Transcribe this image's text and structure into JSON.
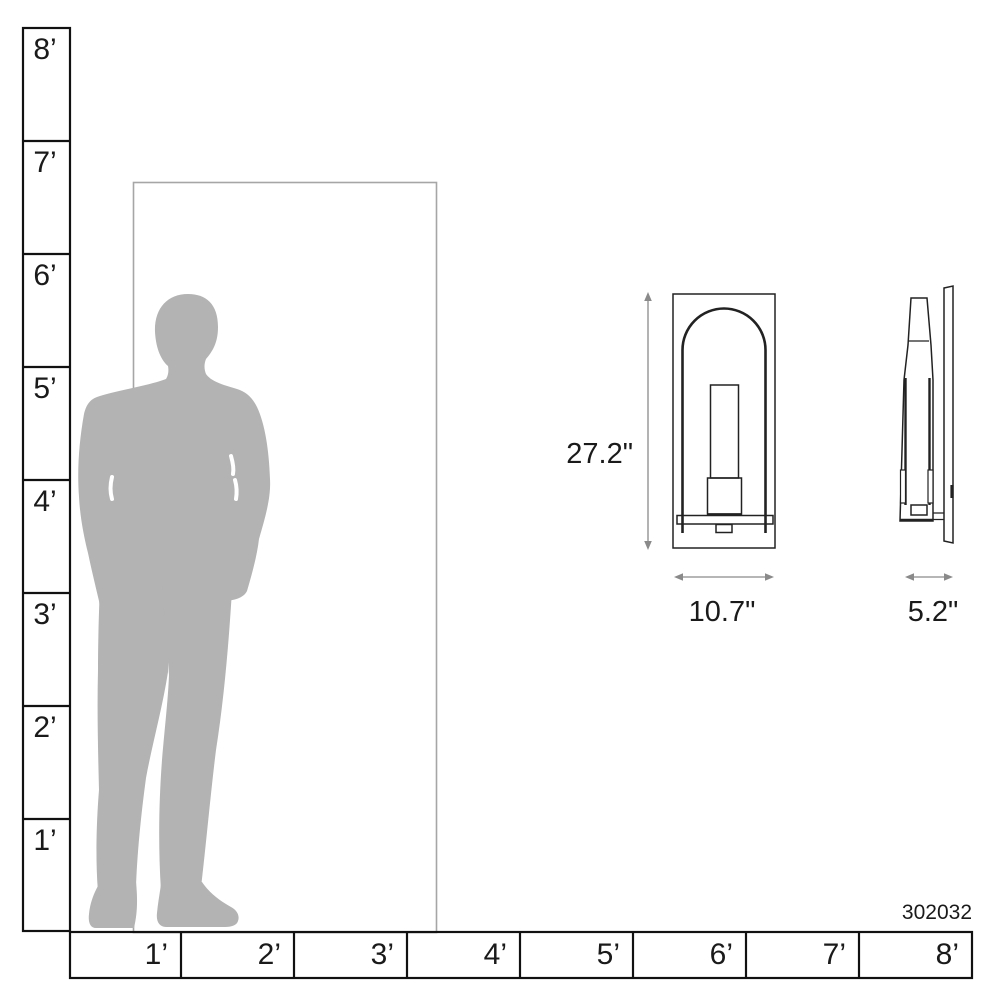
{
  "product": {
    "model_number": "302032"
  },
  "rulers": {
    "vertical": {
      "unit": "feet",
      "labels": [
        "8’",
        "7’",
        "6’",
        "5’",
        "4’",
        "3’",
        "2’",
        "1’"
      ]
    },
    "horizontal": {
      "unit": "feet",
      "labels": [
        "1’",
        "2’",
        "3’",
        "4’",
        "5’",
        "6’",
        "7’",
        "8’"
      ]
    }
  },
  "dimensions": {
    "height": "27.2\"",
    "width": "10.7\"",
    "depth": "5.2\""
  },
  "figures": {
    "person": "human-silhouette-scale-reference",
    "door": "door-outline-scale-reference",
    "front_view": "sconce-front-view",
    "side_view": "sconce-side-view"
  },
  "colors": {
    "silhouette": "#b3b3b3",
    "door_line": "#a6a6a6",
    "ruler_line": "#111111",
    "drawing_line": "#222222",
    "dimension_line": "#8a8a8a",
    "text": "#1a1a1a",
    "background": "#ffffff"
  }
}
